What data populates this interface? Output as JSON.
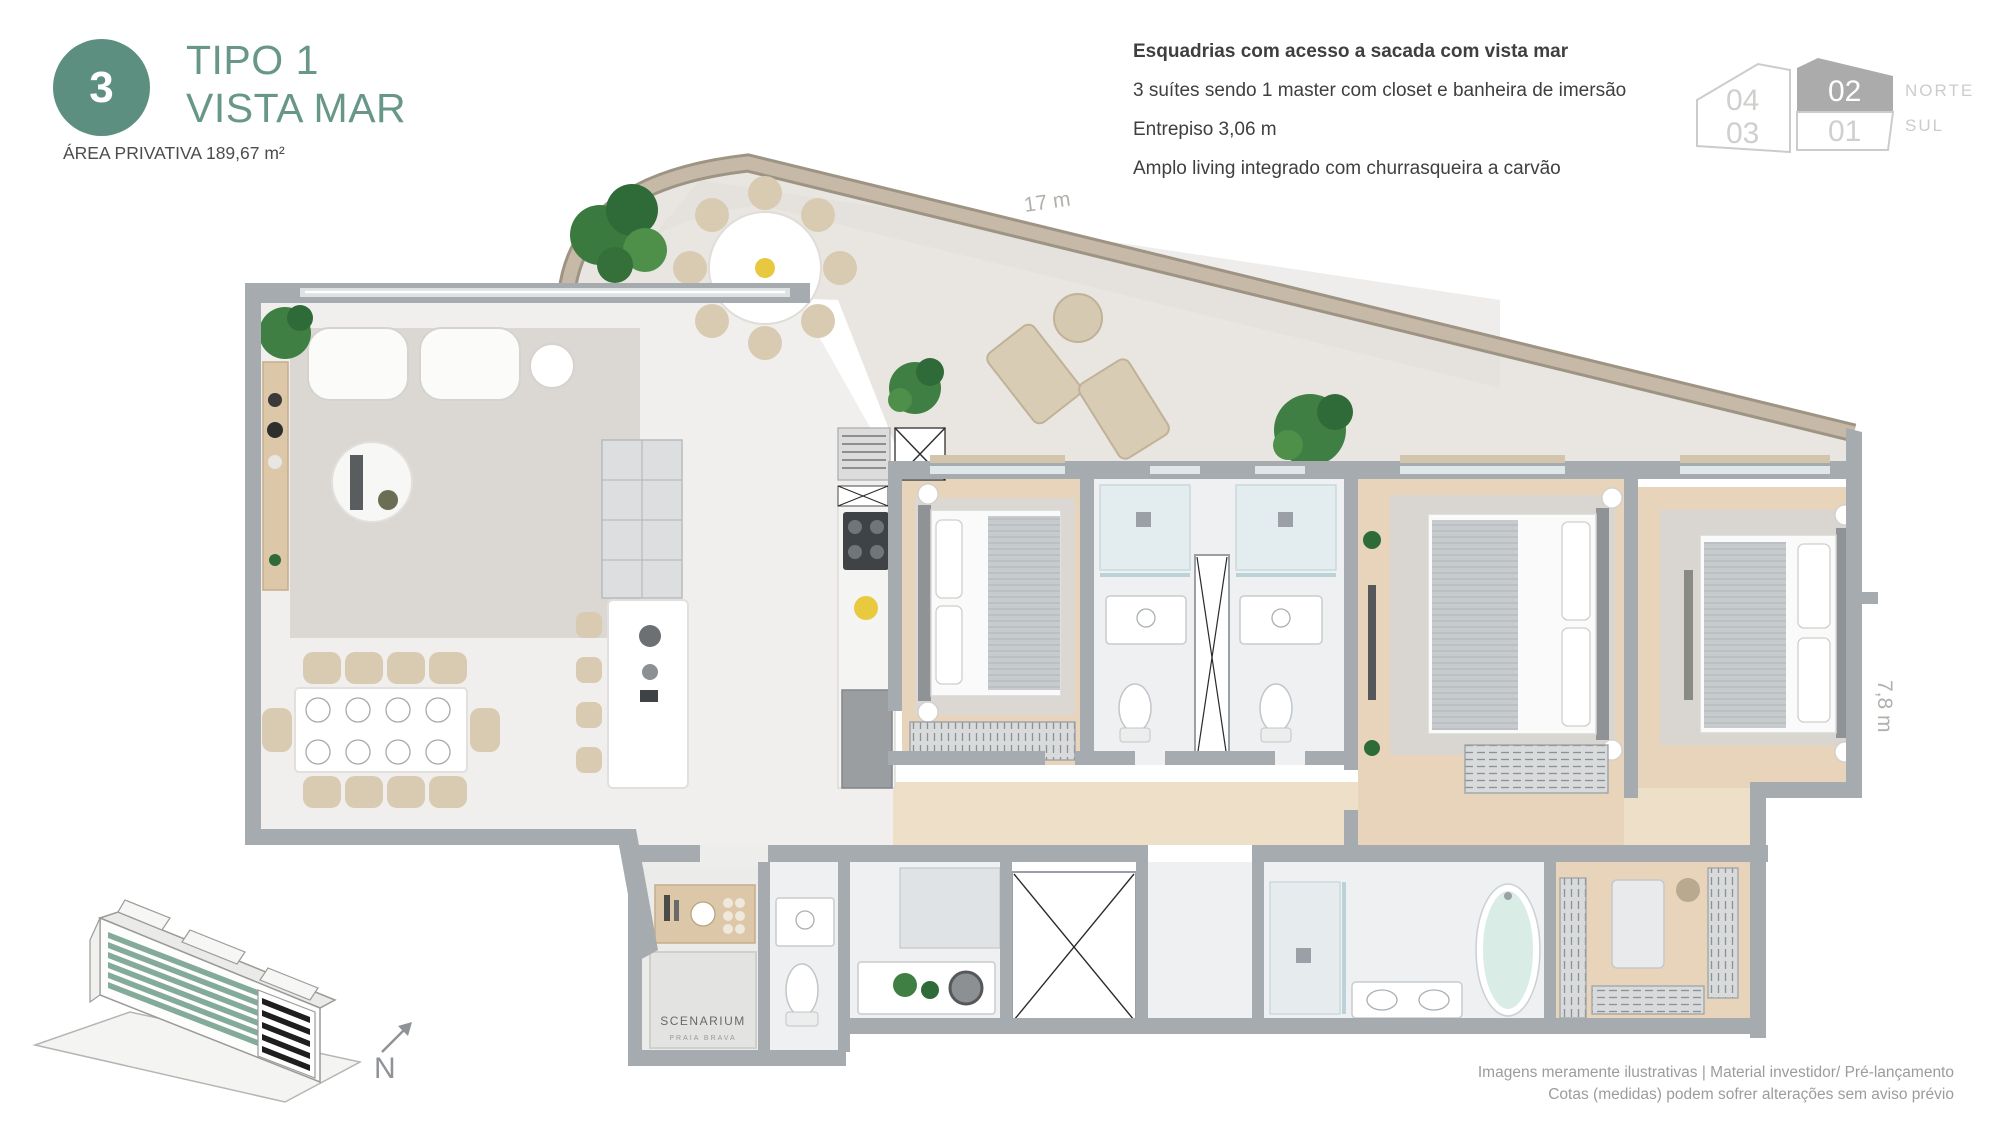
{
  "header": {
    "badge": "3",
    "title_line1": "TIPO 1",
    "title_line2": "VISTA MAR",
    "area": "ÁREA PRIVATIVA 189,67 m²"
  },
  "features": {
    "bold": "Esquadrias com acesso a sacada com vista mar",
    "item2": "3 suítes sendo 1 master com closet e banheira de imersão",
    "item3": "Entrepiso 3,06 m",
    "item4": "Amplo living integrado com churrasqueira a carvão"
  },
  "unit_key": {
    "u04": "04",
    "u03": "03",
    "u02": "02",
    "u01": "01",
    "norte": "NORTE",
    "sul": "SUL",
    "selected": "02"
  },
  "dimensions": {
    "width": "17 m",
    "depth": "7,8 m"
  },
  "plan_logo": {
    "line1": "SCENARIUM",
    "line2": "PRAIA BRAVA"
  },
  "compass": {
    "n": "N"
  },
  "footer": {
    "line1": "Imagens meramente ilustrativas | Material investidor/ Pré-lançamento",
    "line2": "Cotas (medidas) podem sofrer alterações sem aviso prévio"
  },
  "colors": {
    "accent": "#68978a",
    "badge": "#5d8f81",
    "wall": "#a6abb0",
    "terrace_band": "#c7b9a7",
    "wood_floor": "#e8d4ba",
    "marble_floor": "#f0efed",
    "tub": "#d9ece6",
    "selected_unit_fill": "#ababab"
  }
}
